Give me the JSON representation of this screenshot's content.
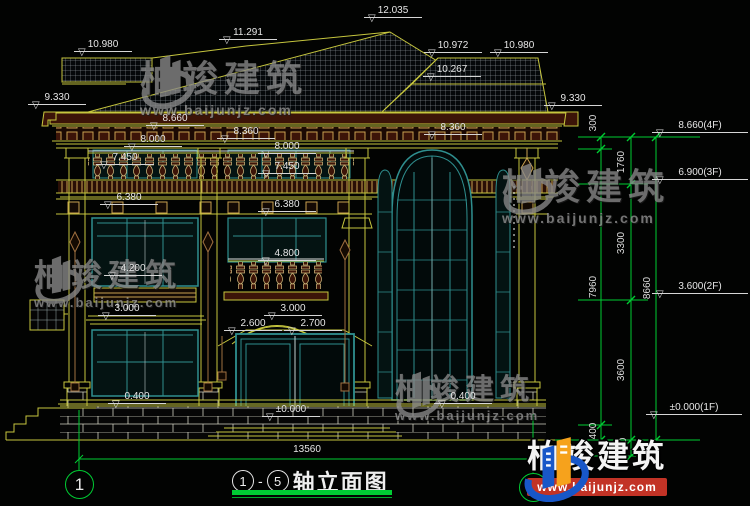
{
  "brand": {
    "name": "柏竣建筑",
    "url": "www.baijunjz.com"
  },
  "icons": {
    "level_triangle": "▽"
  },
  "title": {
    "axis_start": "1",
    "dash": "-",
    "axis_end": "5",
    "name": "轴立面图"
  },
  "bottom_dimension": "13560",
  "axis_bubbles": {
    "left": "1",
    "right": "5"
  },
  "markers": [
    {
      "t": "10.980",
      "x": 74,
      "y": 39
    },
    {
      "t": "11.291",
      "x": 219,
      "y": 27
    },
    {
      "t": "12.035",
      "x": 364,
      "y": 5
    },
    {
      "t": "10.972",
      "x": 424,
      "y": 40
    },
    {
      "t": "10.980",
      "x": 490,
      "y": 40
    },
    {
      "t": "10.267",
      "x": 423,
      "y": 64
    },
    {
      "t": "9.330",
      "x": 28,
      "y": 92
    },
    {
      "t": "9.330",
      "x": 544,
      "y": 93
    },
    {
      "t": "8.660",
      "x": 146,
      "y": 113
    },
    {
      "t": "8.360",
      "x": 217,
      "y": 126
    },
    {
      "t": "8.000",
      "x": 124,
      "y": 134
    },
    {
      "t": "8.360",
      "x": 424,
      "y": 122
    },
    {
      "t": "8.000",
      "x": 258,
      "y": 141
    },
    {
      "t": "7.450",
      "x": 96,
      "y": 152
    },
    {
      "t": "7.450",
      "x": 258,
      "y": 161
    },
    {
      "t": "6.380",
      "x": 100,
      "y": 192
    },
    {
      "t": "6.380",
      "x": 258,
      "y": 199
    },
    {
      "t": "4.800",
      "x": 258,
      "y": 248
    },
    {
      "t": "4.200",
      "x": 104,
      "y": 263
    },
    {
      "t": "3.000",
      "x": 98,
      "y": 303
    },
    {
      "t": "3.000",
      "x": 264,
      "y": 303
    },
    {
      "t": "2.600",
      "x": 224,
      "y": 318
    },
    {
      "t": "2.700",
      "x": 284,
      "y": 318
    },
    {
      "t": "0.400",
      "x": 108,
      "y": 391
    },
    {
      "t": "±0.000",
      "x": 262,
      "y": 404
    },
    {
      "t": "0.400",
      "x": 434,
      "y": 391
    }
  ],
  "panel_levels": [
    {
      "t": "8.660(4F)",
      "x": 652,
      "y": 120
    },
    {
      "t": "6.900(3F)",
      "x": 652,
      "y": 167
    },
    {
      "t": "3.600(2F)",
      "x": 652,
      "y": 281
    },
    {
      "t": "±0.000(1F)",
      "x": 646,
      "y": 402
    }
  ],
  "vertical_dims": [
    {
      "t": "300",
      "x": 576,
      "y": 117
    },
    {
      "t": "1760",
      "x": 604,
      "y": 156
    },
    {
      "t": "3300",
      "x": 604,
      "y": 237
    },
    {
      "t": "3600",
      "x": 604,
      "y": 364
    },
    {
      "t": "450",
      "x": 606,
      "y": 440
    },
    {
      "t": "400",
      "x": 576,
      "y": 425
    },
    {
      "t": "7960",
      "x": 576,
      "y": 281
    },
    {
      "t": "8660",
      "x": 630,
      "y": 282
    }
  ]
}
